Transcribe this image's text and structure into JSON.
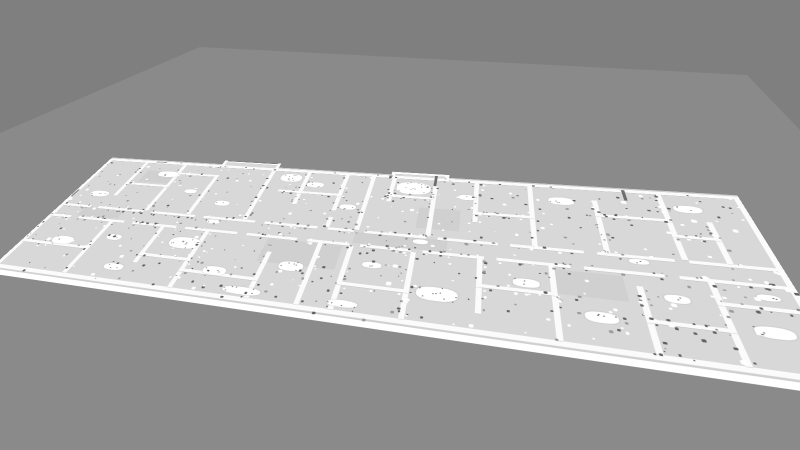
{
  "scene": {
    "kind": "3d-viewport-floorplan-mesh",
    "colors": {
      "sky": "#7f7f7f",
      "ground": "#8a8a8a",
      "floor": "#d8d8d8",
      "floor_patch": "#d0d0d0",
      "wall": "#fbfbfb",
      "slab_edge": "#ffffff",
      "edge_shade": "#cfcfcf",
      "speck_dark": "#616161",
      "speck_mid": "#9b9b9b",
      "speck_light": "#ffffff"
    },
    "ground_polygon": [
      [
        0,
        133
      ],
      [
        200,
        47
      ],
      [
        747,
        75
      ],
      [
        800,
        130
      ],
      [
        800,
        450
      ],
      [
        0,
        450
      ]
    ],
    "plan": {
      "width": 1200,
      "height": 420,
      "dst_corners": [
        [
          116,
          154
        ],
        [
          734,
          190
        ],
        [
          868,
          405
        ],
        [
          -17,
          275
        ]
      ],
      "far_edge_line": [
        0,
        16,
        1200,
        4
      ],
      "floors": [
        [
          0,
          20,
          1200,
          378
        ],
        [
          280,
          0,
          120,
          30
        ],
        [
          640,
          6,
          100,
          24
        ]
      ],
      "slab_edge": [
        0,
        389,
        1200,
        25
      ],
      "slab_edge_line": [
        0,
        399,
        1200,
        3
      ],
      "floor_patches": [
        [
          460,
          246,
          130,
          60
        ],
        [
          604,
          206,
          150,
          30
        ],
        [
          60,
          206,
          90,
          28
        ],
        [
          900,
          250,
          96,
          52
        ],
        [
          120,
          60,
          70,
          44
        ],
        [
          700,
          120,
          70,
          60
        ]
      ],
      "walls": [
        [
          0,
          20,
          1200,
          9
        ],
        [
          0,
          20,
          8,
          378
        ],
        [
          1192,
          20,
          8,
          378
        ],
        [
          0,
          389,
          1200,
          9
        ],
        [
          276,
          0,
          128,
          7
        ],
        [
          276,
          0,
          7,
          30
        ],
        [
          397,
          0,
          7,
          30
        ],
        [
          636,
          6,
          108,
          7
        ],
        [
          636,
          6,
          7,
          24
        ],
        [
          737,
          6,
          7,
          24
        ],
        [
          0,
          200,
          70,
          7
        ],
        [
          88,
          200,
          102,
          7
        ],
        [
          208,
          200,
          92,
          7
        ],
        [
          318,
          200,
          102,
          7
        ],
        [
          438,
          200,
          98,
          7
        ],
        [
          554,
          200,
          46,
          7
        ],
        [
          618,
          200,
          102,
          7
        ],
        [
          738,
          200,
          92,
          7
        ],
        [
          848,
          200,
          104,
          7
        ],
        [
          970,
          200,
          100,
          7
        ],
        [
          1088,
          200,
          104,
          7
        ],
        [
          0,
          237,
          50,
          7
        ],
        [
          68,
          237,
          102,
          7
        ],
        [
          188,
          237,
          92,
          7
        ],
        [
          298,
          237,
          102,
          7
        ],
        [
          418,
          237,
          92,
          7
        ],
        [
          528,
          237,
          72,
          7
        ],
        [
          618,
          237,
          82,
          7
        ],
        [
          718,
          237,
          92,
          7
        ],
        [
          828,
          237,
          102,
          7
        ],
        [
          948,
          237,
          102,
          7
        ],
        [
          1068,
          237,
          124,
          7
        ],
        [
          95,
          29,
          8,
          131
        ],
        [
          190,
          29,
          8,
          171
        ],
        [
          280,
          60,
          8,
          140
        ],
        [
          394,
          29,
          8,
          171
        ],
        [
          470,
          29,
          8,
          111
        ],
        [
          548,
          29,
          8,
          121
        ],
        [
          548,
          170,
          8,
          30
        ],
        [
          600,
          29,
          8,
          171
        ],
        [
          640,
          29,
          8,
          80
        ],
        [
          718,
          48,
          8,
          152
        ],
        [
          790,
          29,
          8,
          121
        ],
        [
          880,
          29,
          8,
          171
        ],
        [
          980,
          60,
          8,
          140
        ],
        [
          1080,
          29,
          8,
          171
        ],
        [
          1135,
          100,
          8,
          100
        ],
        [
          95,
          110,
          103,
          7
        ],
        [
          190,
          60,
          98,
          7
        ],
        [
          430,
          96,
          126,
          7
        ],
        [
          640,
          86,
          86,
          7
        ],
        [
          790,
          120,
          98,
          7
        ],
        [
          980,
          100,
          108,
          7
        ],
        [
          1080,
          140,
          63,
          7
        ],
        [
          140,
          244,
          8,
          145
        ],
        [
          250,
          244,
          8,
          100
        ],
        [
          340,
          244,
          8,
          145
        ],
        [
          470,
          280,
          8,
          109
        ],
        [
          548,
          244,
          8,
          145
        ],
        [
          600,
          244,
          8,
          145
        ],
        [
          700,
          244,
          8,
          145
        ],
        [
          800,
          244,
          8,
          116
        ],
        [
          900,
          244,
          8,
          145
        ],
        [
          1010,
          268,
          8,
          121
        ],
        [
          1100,
          244,
          8,
          145
        ],
        [
          0,
          318,
          140,
          7
        ],
        [
          250,
          318,
          98,
          7
        ],
        [
          600,
          330,
          108,
          7
        ],
        [
          800,
          300,
          108,
          7
        ],
        [
          1010,
          330,
          98,
          7
        ],
        [
          1100,
          282,
          92,
          7
        ],
        [
          340,
          344,
          138,
          7
        ]
      ],
      "dark_marks": [
        [
          283,
          0,
          114,
          3,
          "#787878"
        ],
        [
          718,
          12,
          5,
          36,
          "#6e6e6e"
        ],
        [
          1030,
          22,
          5,
          32,
          "#6e6e6e"
        ],
        [
          2,
          150,
          5,
          26,
          "#909090"
        ],
        [
          120,
          22,
          26,
          3,
          "#9a9a9a"
        ]
      ],
      "clutter": [
        [
          150,
          58,
          46,
          22,
          0
        ],
        [
          40,
          148,
          42,
          20,
          3
        ],
        [
          240,
          118,
          26,
          14,
          0
        ],
        [
          320,
          148,
          30,
          16,
          2
        ],
        [
          420,
          38,
          44,
          28,
          8
        ],
        [
          480,
          62,
          34,
          18,
          4
        ],
        [
          652,
          40,
          62,
          40,
          12
        ],
        [
          764,
          70,
          30,
          16,
          2
        ],
        [
          912,
          58,
          40,
          22,
          4
        ],
        [
          1098,
          58,
          40,
          20,
          3
        ],
        [
          560,
          128,
          30,
          16,
          2
        ],
        [
          330,
          208,
          26,
          13,
          0
        ],
        [
          700,
          210,
          24,
          12,
          0
        ],
        [
          1010,
          208,
          26,
          12,
          2
        ],
        [
          60,
          298,
          44,
          22,
          4
        ],
        [
          162,
          278,
          30,
          16,
          2
        ],
        [
          288,
          266,
          58,
          30,
          10
        ],
        [
          380,
          330,
          40,
          20,
          3
        ],
        [
          500,
          298,
          40,
          22,
          6
        ],
        [
          630,
          278,
          30,
          14,
          2
        ],
        [
          718,
          318,
          58,
          28,
          10
        ],
        [
          850,
          278,
          36,
          18,
          3
        ],
        [
          938,
          328,
          40,
          20,
          4
        ],
        [
          1040,
          278,
          30,
          16,
          2
        ],
        [
          1128,
          318,
          42,
          20,
          4
        ],
        [
          430,
          368,
          62,
          16,
          5
        ],
        [
          1150,
          258,
          26,
          12,
          2
        ],
        [
          205,
          352,
          36,
          16,
          3
        ],
        [
          596,
          368,
          44,
          14,
          4
        ]
      ],
      "noise": {
        "seed": 11,
        "count": 900,
        "wall_ratio": 0.6,
        "white_blobs": 80
      }
    }
  }
}
